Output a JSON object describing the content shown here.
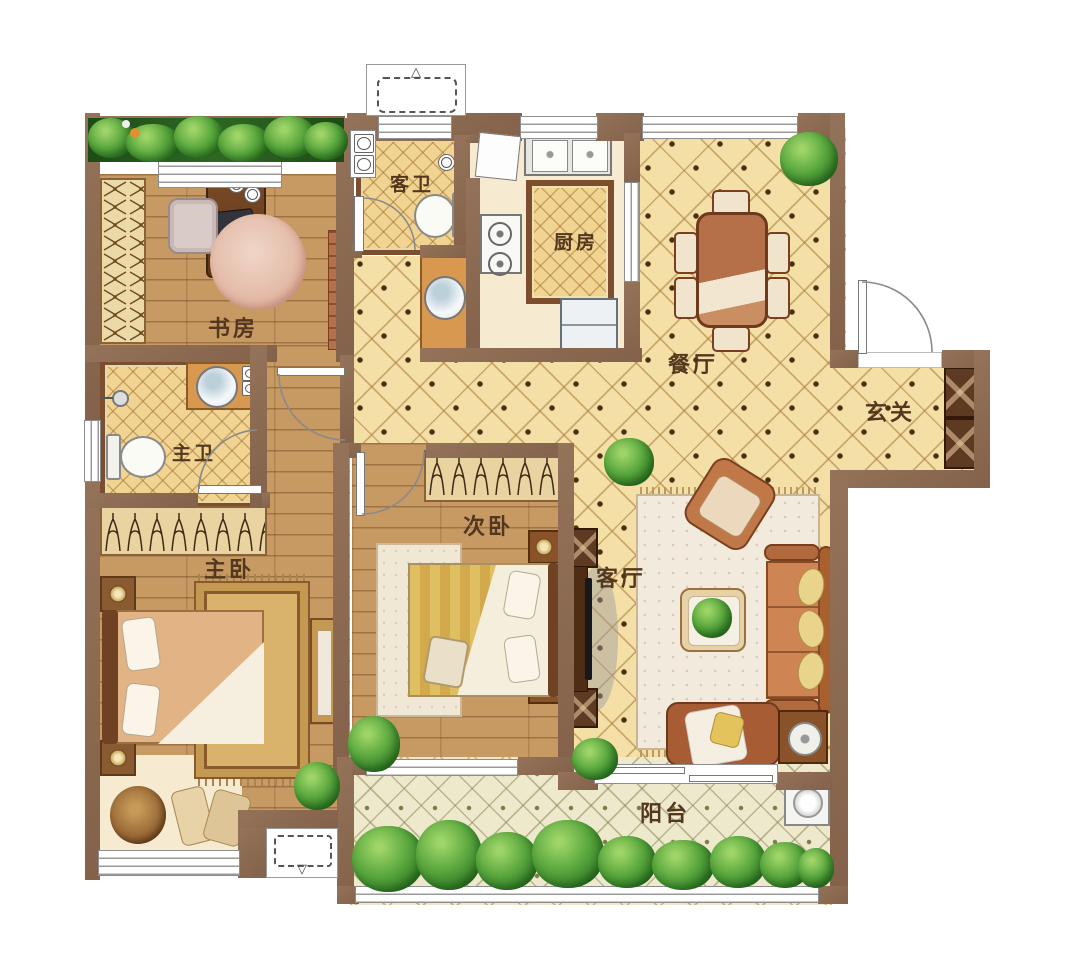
{
  "rooms": {
    "study": {
      "label": "书房"
    },
    "guest_bath": {
      "label": "客卫"
    },
    "kitchen": {
      "label": "厨房"
    },
    "dining": {
      "label": "餐厅"
    },
    "entry": {
      "label": "玄关"
    },
    "master_bath": {
      "label": "主卫"
    },
    "master_bedroom": {
      "label": "主卧"
    },
    "second_bedroom": {
      "label": "次卧"
    },
    "living": {
      "label": "客厅"
    },
    "balcony": {
      "label": "阳台"
    }
  },
  "icons": {
    "ac_arrow_up": "△",
    "ac_arrow_down": "▽"
  },
  "colors": {
    "wall": "#8d6c54",
    "tile_floor": "#f4dfa6",
    "wood_floor": "#c79a63",
    "bath_tile": "#f1d491",
    "balcony_tile": "#eee8cd",
    "plant_green": "#4e9b3a",
    "furniture_brown": "#b5714a",
    "counter_orange": "#d8984f"
  }
}
